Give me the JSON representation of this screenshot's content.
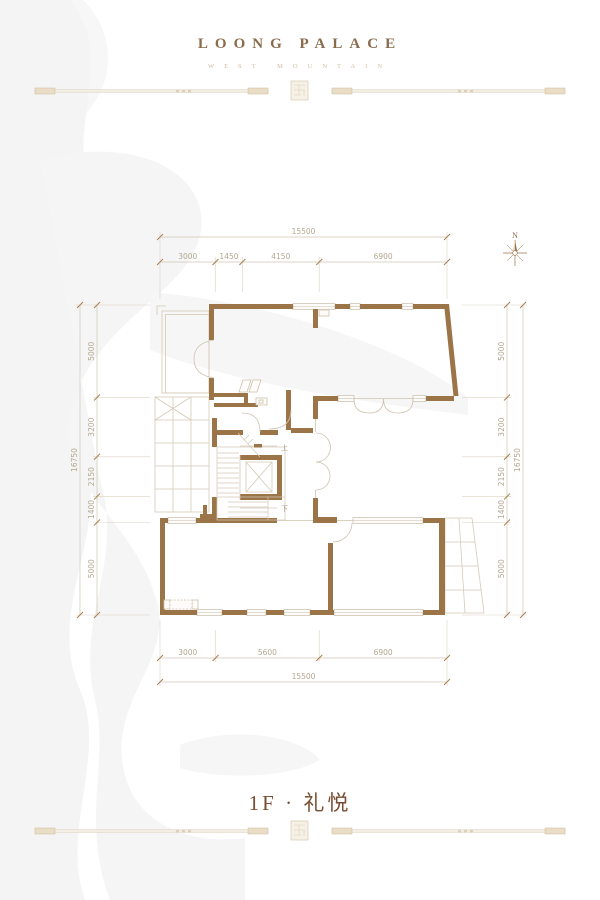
{
  "header": {
    "title": "LOONG PALACE",
    "subtitle": "WEST MOUNTAIN"
  },
  "footer": {
    "title": "1F · 礼悦"
  },
  "compass": {
    "label": "N"
  },
  "plan": {
    "stair_up": "上",
    "stair_down": "下",
    "colors": {
      "wall": "#9b7448",
      "thin_line": "#d5cab7",
      "dim_line": "#d2c7b4",
      "ext_line": "#ddd3c2",
      "dim_text": "#b3a78f",
      "tick": "#a87f4f",
      "header_text": "#8a6b4c",
      "subtitle_text": "#cfc0a8",
      "title_text": "#7a4e33",
      "watermark": "#f4f4f4",
      "rule": "#e9e0cf"
    }
  },
  "dimensions": {
    "top": {
      "total": "15500",
      "segments": [
        "3000",
        "1450",
        "4150",
        "6900"
      ]
    },
    "bottom": {
      "total": "15500",
      "segments": [
        "3000",
        "5600",
        "6900"
      ]
    },
    "left": {
      "total": "16750",
      "segments": [
        "5000",
        "3200",
        "2150",
        "1400",
        "5000"
      ]
    },
    "right": {
      "total": "16750",
      "segments": [
        "5000",
        "3200",
        "2150",
        "1400",
        "5000"
      ]
    }
  }
}
